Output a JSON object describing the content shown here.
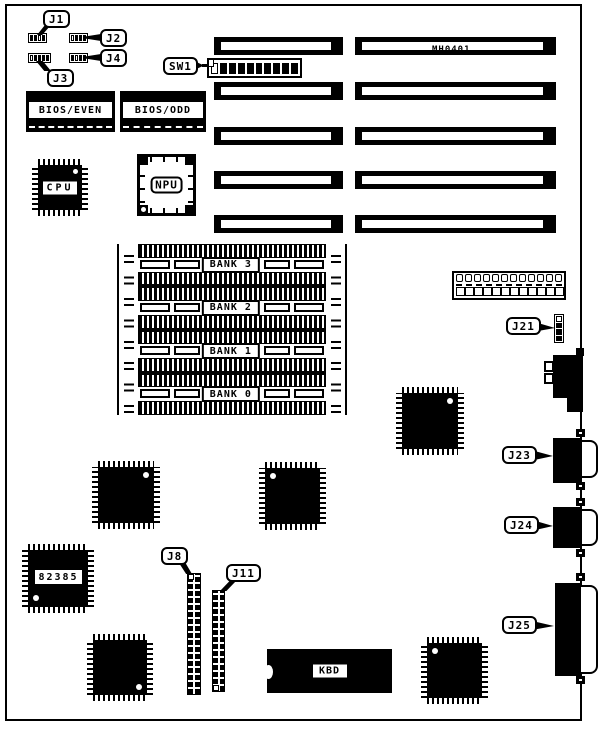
{
  "board": {
    "model": "MH0401",
    "callouts": {
      "j1": "J1",
      "j2": "J2",
      "j3": "J3",
      "j4": "J4",
      "sw1": "SW1",
      "j8": "J8",
      "j11": "J11",
      "j21": "J21",
      "j23": "J23",
      "j24": "J24",
      "j25": "J25"
    },
    "chips": {
      "bios_even": "BIOS/EVEN",
      "bios_odd": "BIOS/ODD",
      "cpu": "CPU",
      "npu": "NPU",
      "cache": "82385",
      "keyboard": "KBD"
    },
    "banks": [
      "BANK 3",
      "BANK 2",
      "BANK 1",
      "BANK 0"
    ],
    "colors": {
      "ink": "#000000",
      "paper": "#ffffff"
    }
  }
}
